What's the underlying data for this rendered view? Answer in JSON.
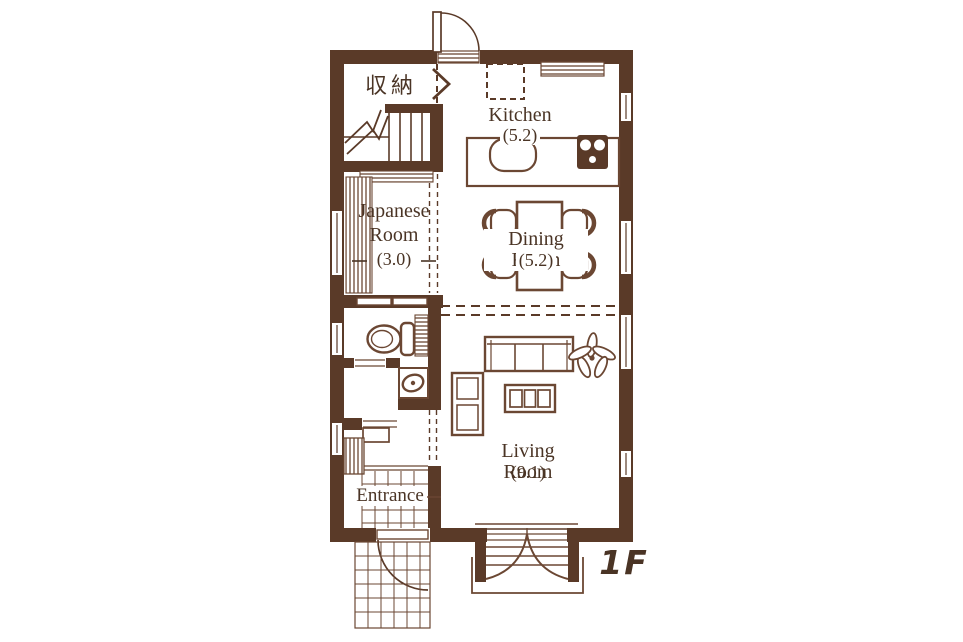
{
  "floor_plan": {
    "floor_label": "1F",
    "rooms": {
      "storage": {
        "label": "収納"
      },
      "kitchen": {
        "label": "Kitchen",
        "size": "(5.2)"
      },
      "japanese_room": {
        "label_line1": "Japanese",
        "label_line2": "Room",
        "size": "(3.0)"
      },
      "dining_room": {
        "label": "Dining Room",
        "size": "(5.2)"
      },
      "living_room": {
        "label": "Living Room",
        "size": "(9.1)"
      },
      "entrance": {
        "label": "Entrance"
      }
    },
    "colors": {
      "wall": "#5a3a28",
      "furniture_line": "#6b4733",
      "text": "#4a3425",
      "background": "#ffffff"
    },
    "icons": [
      "stairs-icon",
      "up-arrow-icon",
      "gas-stove-icon",
      "kitchen-sink-icon",
      "refrigerator-space-icon",
      "dining-table-icon",
      "chair-icon",
      "sofa-icon",
      "tv-board-icon",
      "shelf-icon",
      "plant-icon",
      "toilet-icon",
      "washbasin-icon",
      "washing-machine-icon",
      "entrance-door-arc-icon",
      "back-door-arc-icon",
      "closet-chevron-icon",
      "curtained-window-icon",
      "deck-icon",
      "tile-grid-icon",
      "window-icon",
      "shoe-cabinet-icon",
      "sliding-door-icon"
    ]
  }
}
